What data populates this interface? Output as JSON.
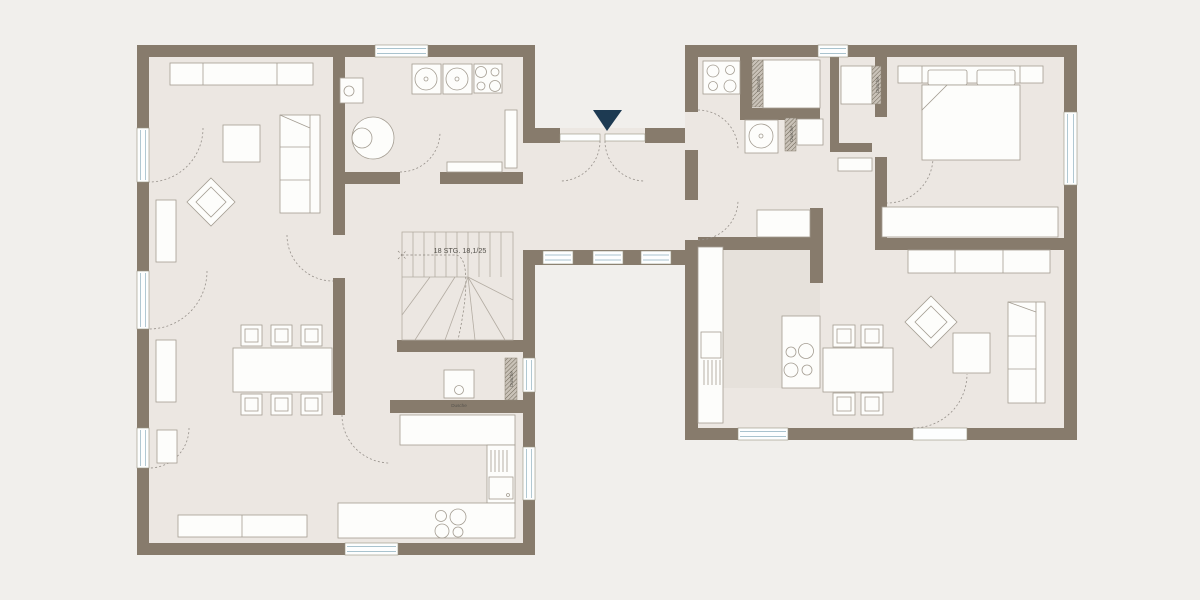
{
  "labels": {
    "stairs": "18 STG. 18,1/25",
    "shower": "Dusche"
  },
  "colors": {
    "background": "#f1efec",
    "floor": "#ece7e2",
    "wall": "#877b6c",
    "furniture-fill": "#fdfdfb",
    "furniture-stroke": "#a49d92",
    "window-line": "#a9c3ce",
    "arc": "#96908a",
    "kitchen-zone": "#e6e1db",
    "entrance-marker": "#1d3a52",
    "label-text": "#55524c"
  }
}
